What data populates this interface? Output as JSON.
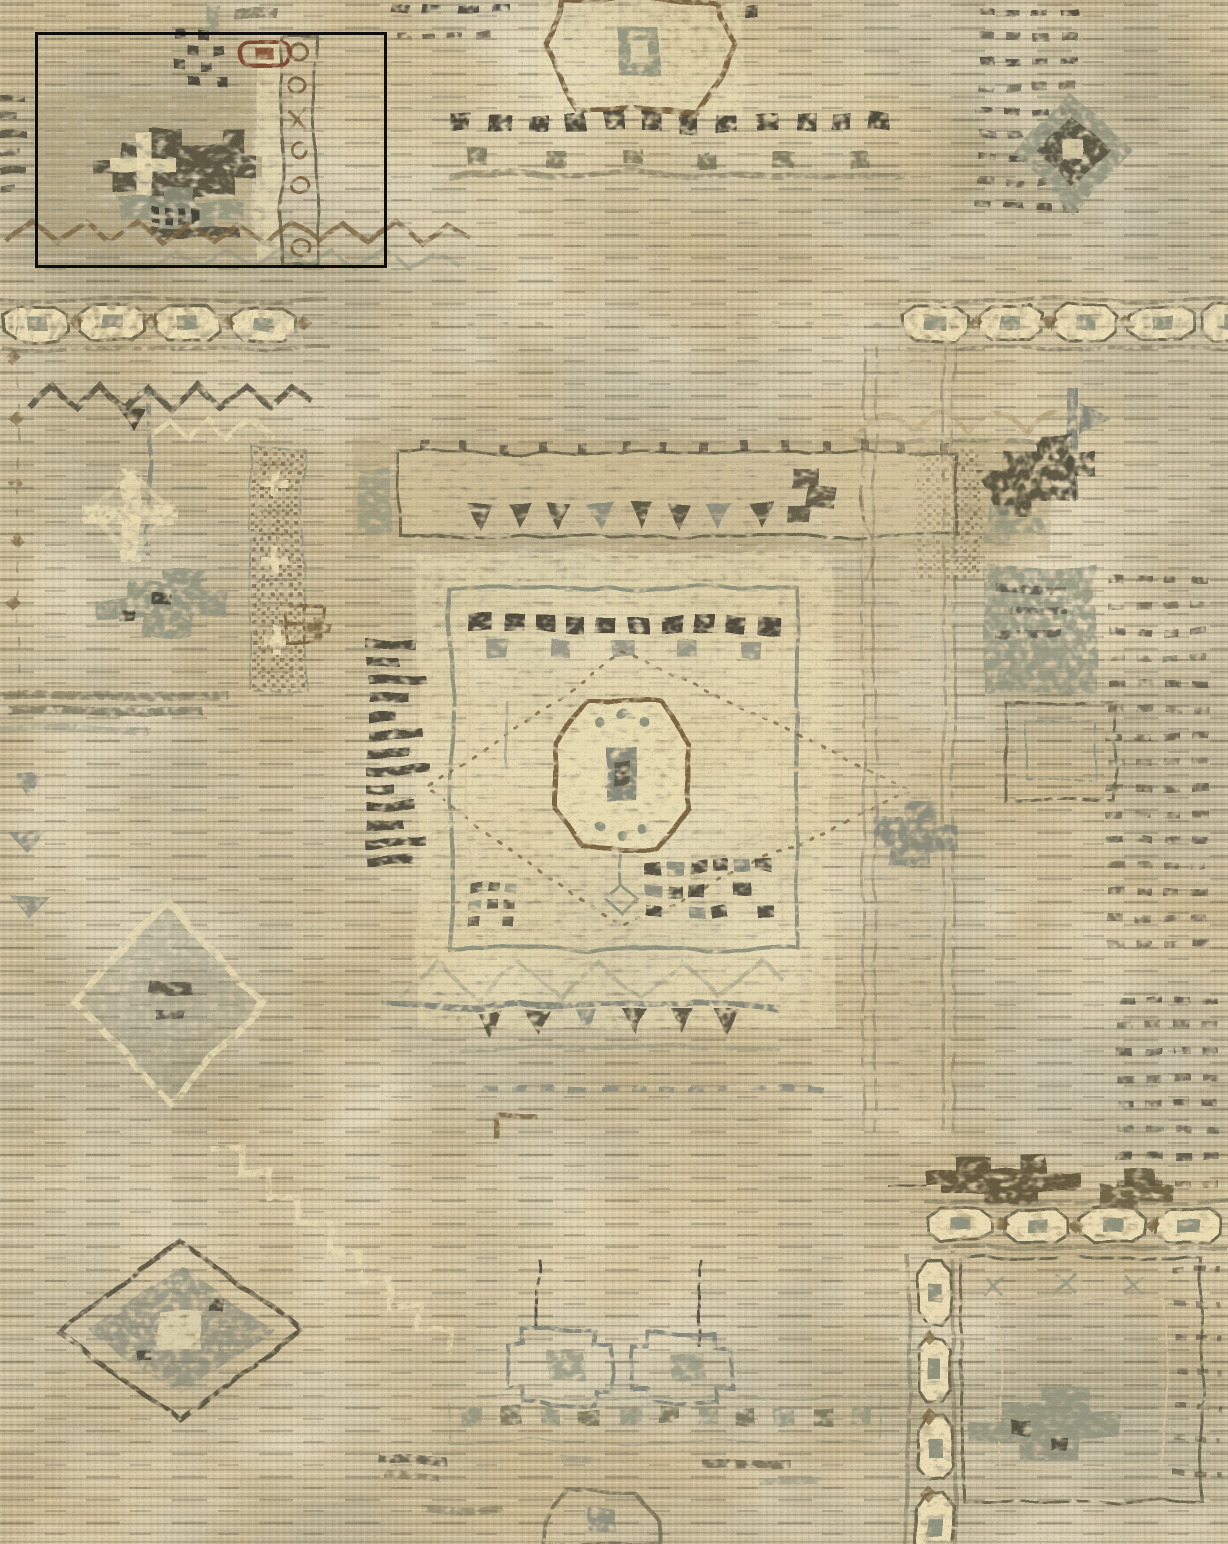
{
  "canvas": {
    "width": 1228,
    "height": 1544
  },
  "subject": {
    "description": "Distressed vintage-style oriental patchwork area rug photographed flat, filling the whole frame",
    "palette_style": "faded beige, sand and taupe field with grey-green, olive, brown and charcoal geometric motifs",
    "overlay": "black rectangular selection outline over the upper-left corner of the rug"
  },
  "annotation_box": {
    "x": 35,
    "y": 32,
    "width": 352,
    "height": 236,
    "stroke_color": "#0d0d0d",
    "stroke_width": 3
  },
  "palette": {
    "base": "#c8b790",
    "sand": "#d7c7a0",
    "cream": "#eaddb4",
    "tan": "#b2a179",
    "sage": "#8f927d",
    "gray": "#7e8277",
    "olive": "#6e684f",
    "dark": "#4e4937",
    "ink": "#3a362b",
    "brown": "#7b6542",
    "rust": "#7d4a30",
    "umber": "#5d5136"
  }
}
